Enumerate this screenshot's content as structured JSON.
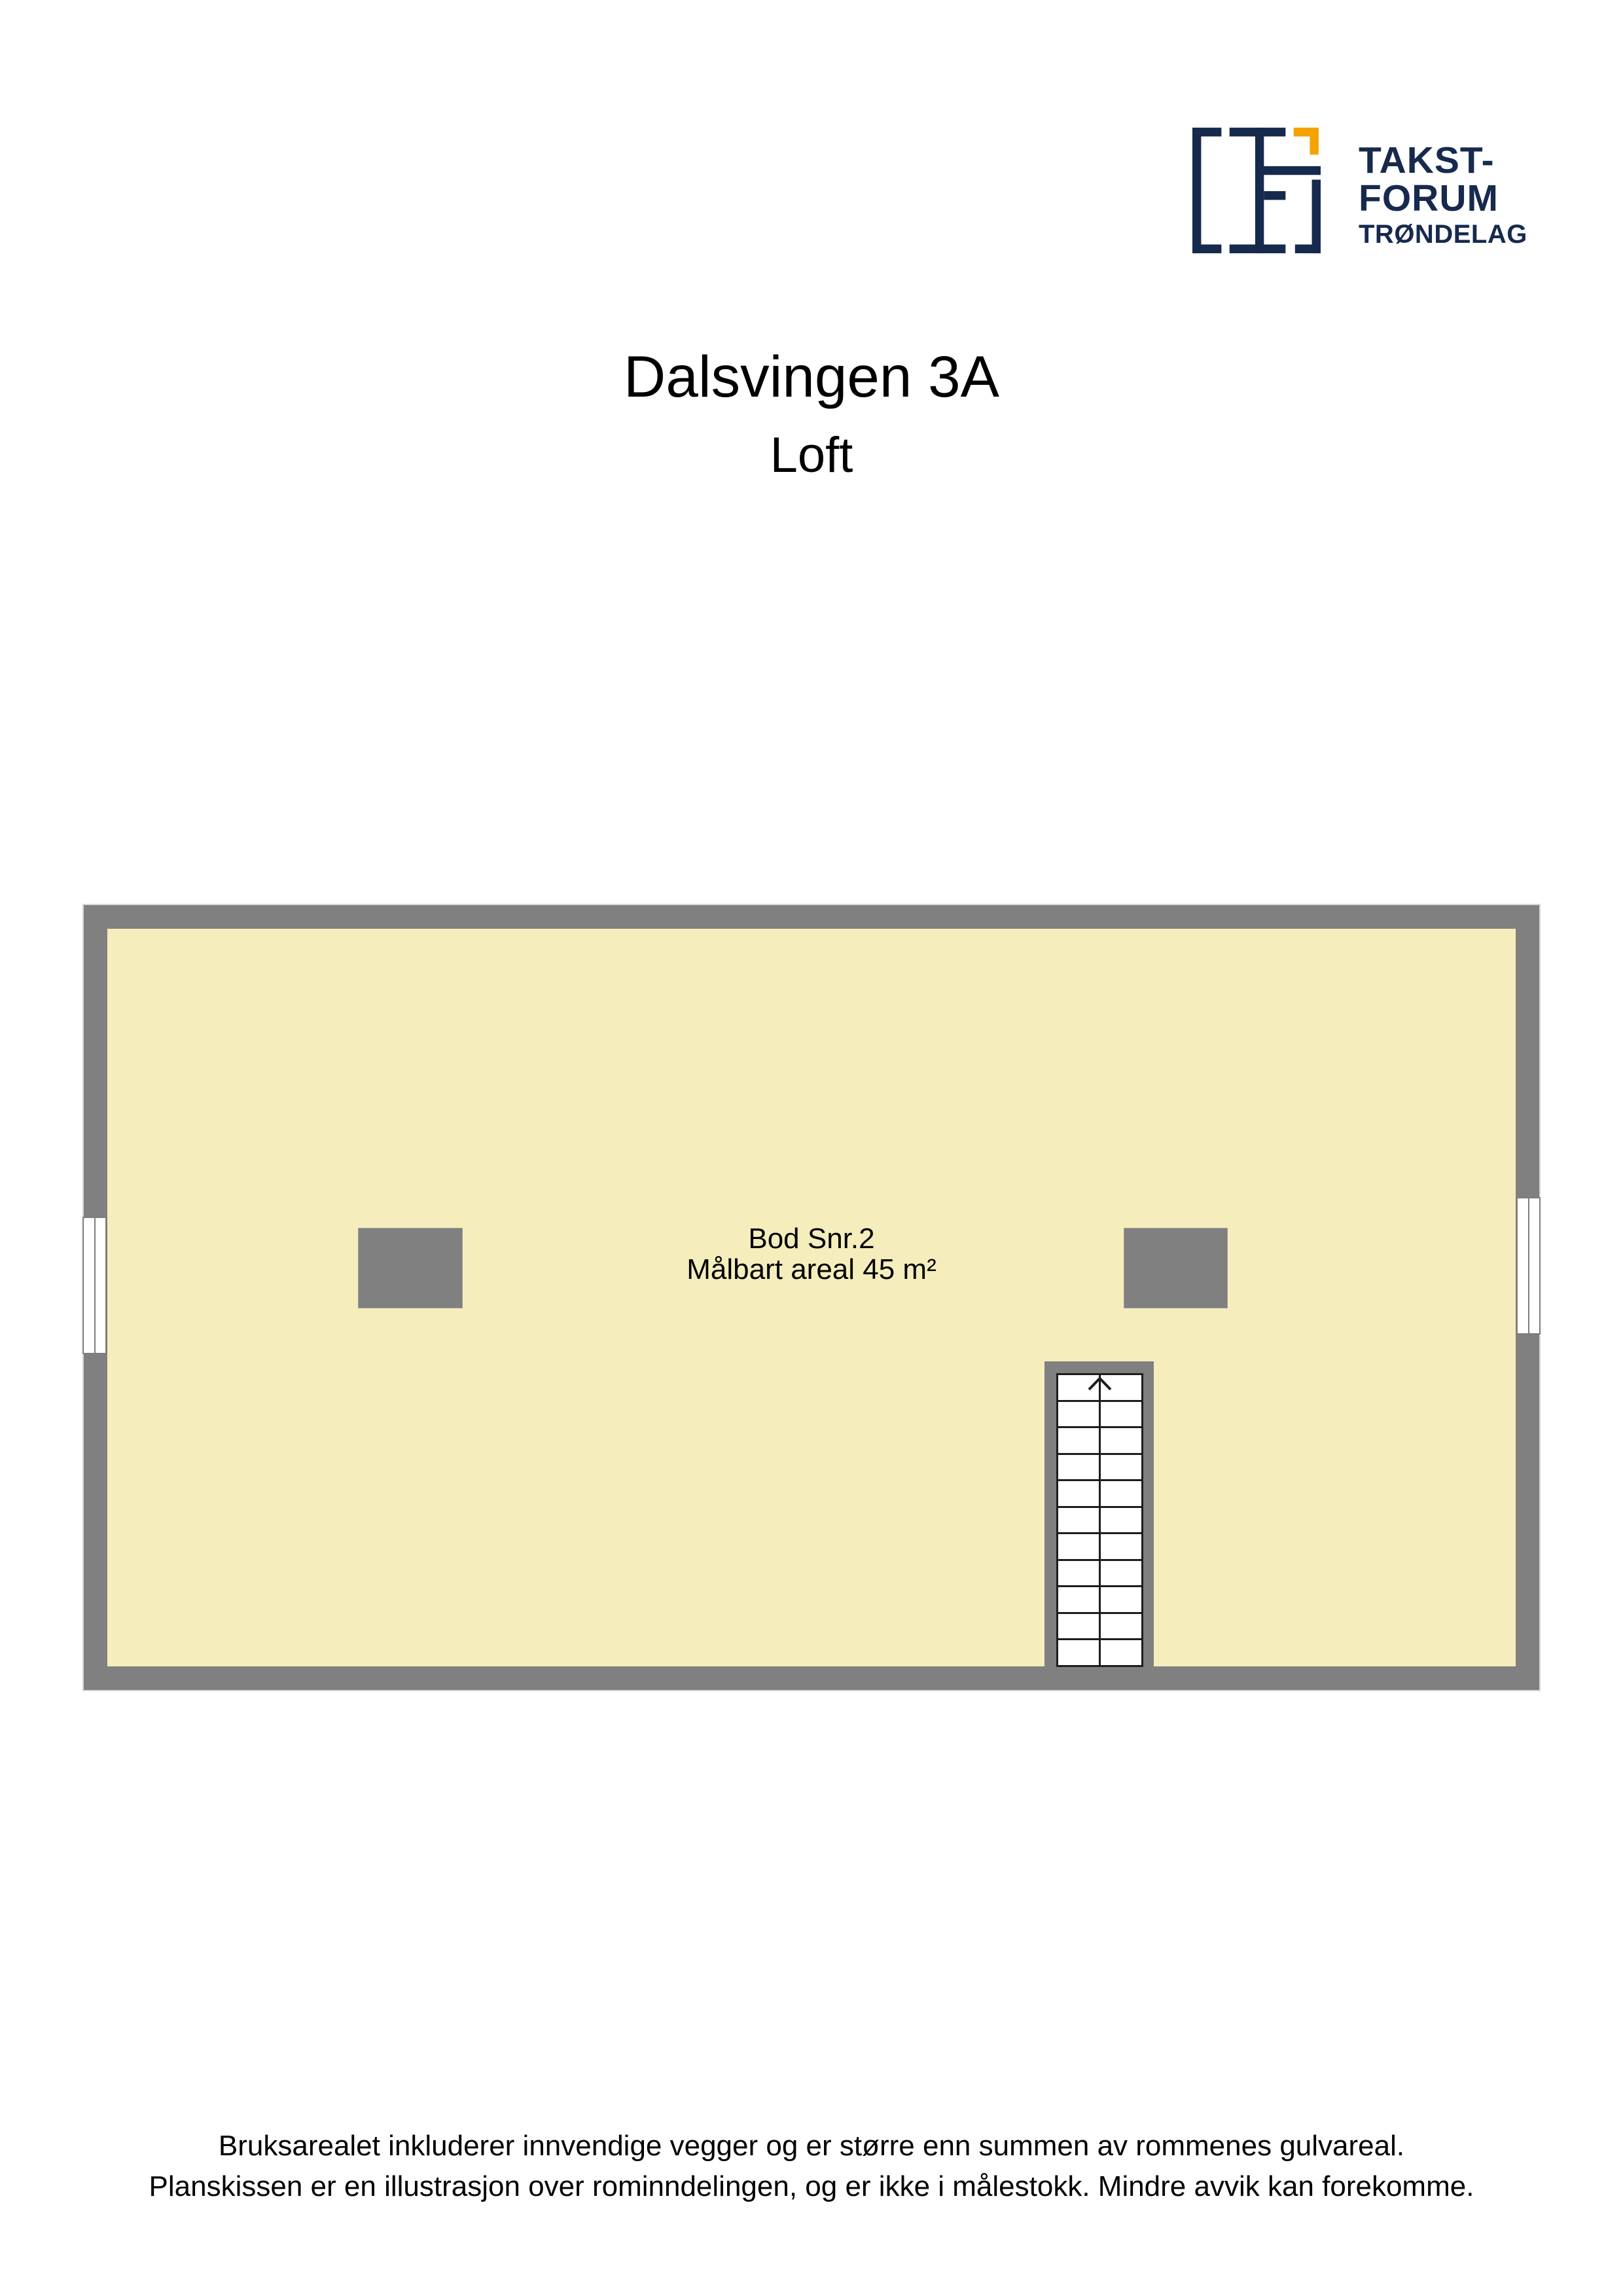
{
  "brand": {
    "line1": "TAKST-",
    "line2": "FORUM",
    "line3": "TRØNDELAG"
  },
  "header": {
    "title": "Dalsvingen 3A",
    "subtitle": "Loft"
  },
  "floorplan": {
    "room": {
      "name": "Bod Snr.2",
      "area": "Målbart areal 45 m²"
    },
    "stair": {
      "treads": 11,
      "direction": "up"
    },
    "windows": [
      "left-wall",
      "right-wall"
    ]
  },
  "footer": {
    "line1": "Bruksarealet inkluderer innvendige vegger og er større enn summen av rommenes gulvareal.",
    "line2": "Planskissen er en illustrasjon over rominndelingen, og er ikke i målestokk. Mindre avvik kan forekomme."
  },
  "colors": {
    "navy": "#162a4d",
    "orange": "#f5a202",
    "wall": "#808080",
    "floor": "#f5edbc",
    "stairline": "#1d1d1d",
    "outline": "#d6d6d6",
    "winframe": "#7d7d7d"
  }
}
